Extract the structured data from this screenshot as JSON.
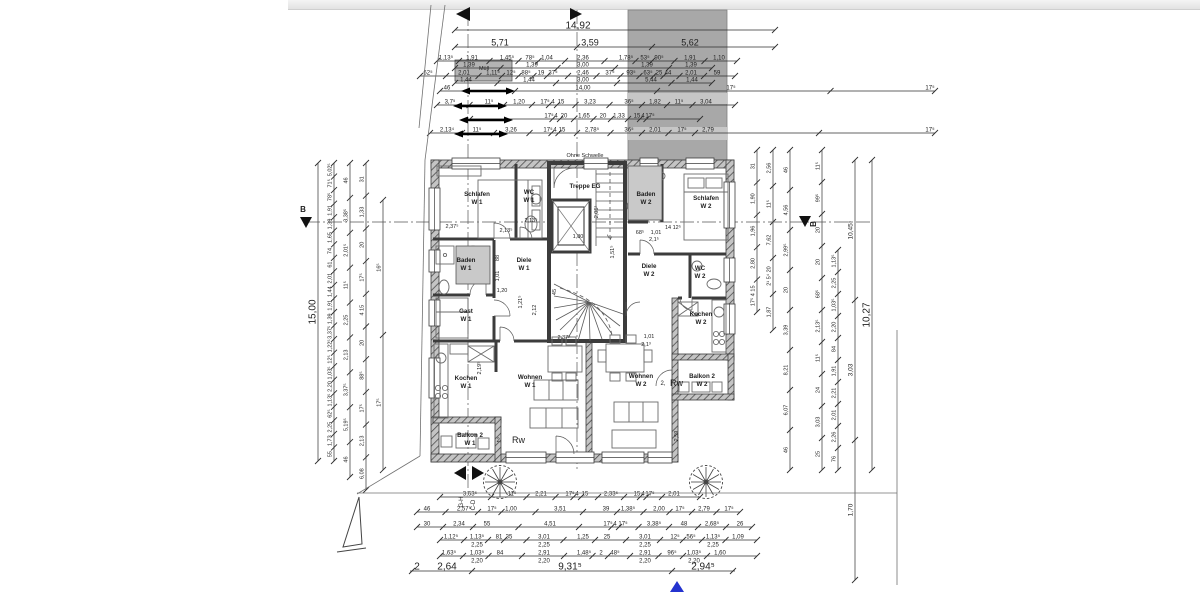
{
  "colors": {
    "blue": "#2433cf",
    "block_gray": "#a8a8a8",
    "block_band": "#c6c6c6",
    "room_gray": "#c9c9c9",
    "muell_gray": "#b3b3b3",
    "line": "#2f2f2f"
  },
  "annotations": {
    "ohne_schwelle": "Ohne Schwelle",
    "muell": "Müll",
    "rw": "Rw",
    "unit2": "2,",
    "section_b": "B",
    "gh": "G-H",
    "cd": "C-D"
  },
  "rooms": [
    {
      "lines": [
        "Schlafen",
        "W 1"
      ],
      "x": 477,
      "y": 196
    },
    {
      "lines": [
        "WC",
        "W 1"
      ],
      "x": 529,
      "y": 194
    },
    {
      "lines": [
        "Treppe EG"
      ],
      "x": 585,
      "y": 188
    },
    {
      "lines": [
        "Baden",
        "W 2"
      ],
      "x": 646,
      "y": 196,
      "rect": [
        628,
        166,
        34,
        54
      ]
    },
    {
      "lines": [
        "Schlafen",
        "W 2"
      ],
      "x": 706,
      "y": 200
    },
    {
      "lines": [
        "Baden",
        "W 1"
      ],
      "x": 466,
      "y": 262,
      "rect": [
        456,
        246,
        34,
        38
      ]
    },
    {
      "lines": [
        "Diele",
        "W 1"
      ],
      "x": 524,
      "y": 262
    },
    {
      "lines": [
        "Diele",
        "W 2"
      ],
      "x": 649,
      "y": 268
    },
    {
      "lines": [
        "WC",
        "W 2"
      ],
      "x": 700,
      "y": 270
    },
    {
      "lines": [
        "Gast",
        "W 1"
      ],
      "x": 466,
      "y": 313
    },
    {
      "lines": [
        "Kochen",
        "W 2"
      ],
      "x": 701,
      "y": 316
    },
    {
      "lines": [
        "Kochen",
        "W 1"
      ],
      "x": 466,
      "y": 380
    },
    {
      "lines": [
        "Wohnen",
        "W 1"
      ],
      "x": 530,
      "y": 379
    },
    {
      "lines": [
        "Wohnen",
        "W 2"
      ],
      "x": 641,
      "y": 378
    },
    {
      "lines": [
        "Balkon 2",
        "W 1"
      ],
      "x": 470,
      "y": 437
    },
    {
      "lines": [
        "Balkon 2",
        "W 2"
      ],
      "x": 702,
      "y": 378
    }
  ],
  "dims": {
    "top_rows": [
      {
        "y": 30,
        "x1": 455,
        "x2": 775,
        "fs": 10,
        "ticks": [
          455,
          775
        ],
        "labels": [
          {
            "t": "14,92",
            "x": 578
          }
        ]
      },
      {
        "y": 47,
        "x1": 455,
        "x2": 775,
        "fs": 9,
        "ticks": [
          455,
          577,
          652,
          775
        ],
        "labels": [
          {
            "t": "5,71",
            "x": 500
          },
          {
            "t": "3,59",
            "x": 590
          },
          {
            "t": "5,62",
            "x": 690
          }
        ]
      },
      {
        "y": 61,
        "x1": 437,
        "x2": 737,
        "labels": [
          {
            "t": "1,13⁵",
            "x": 446
          },
          {
            "t": "1,91",
            "x": 472
          },
          {
            "t": "1,45⁵",
            "x": 507
          },
          {
            "t": "78⁵",
            "x": 530
          },
          {
            "t": "1,04",
            "x": 547
          },
          {
            "t": "2,36",
            "x": 583
          },
          {
            "t": "1,78⁵",
            "x": 626
          },
          {
            "t": "53⁵",
            "x": 645
          },
          {
            "t": "90⁵",
            "x": 659
          },
          {
            "t": "1,91",
            "x": 690
          },
          {
            "t": "1,10",
            "x": 719
          }
        ]
      },
      {
        "y": 68,
        "x1": 455,
        "x2": 712,
        "labels": [
          {
            "t": "1,39",
            "x": 469
          },
          {
            "t": "1,39",
            "x": 532
          },
          {
            "t": "3,00",
            "x": 583
          },
          {
            "t": "1,39",
            "x": 647
          },
          {
            "t": "1,39",
            "x": 691
          }
        ]
      },
      {
        "y": 76,
        "x1": 420,
        "x2": 735,
        "labels": [
          {
            "t": "62⁵",
            "x": 428
          },
          {
            "t": "2,01",
            "x": 464
          },
          {
            "t": "1,11⁵",
            "x": 493
          },
          {
            "t": "12⁵",
            "x": 511
          },
          {
            "t": "88⁵",
            "x": 526
          },
          {
            "t": "19",
            "x": 541
          },
          {
            "t": "37⁵",
            "x": 553
          },
          {
            "t": "2,46",
            "x": 583
          },
          {
            "t": "37⁵",
            "x": 610
          },
          {
            "t": "93⁵",
            "x": 631
          },
          {
            "t": "63⁵",
            "x": 648
          },
          {
            "t": "25",
            "x": 659
          },
          {
            "t": "44",
            "x": 668
          },
          {
            "t": "2,01",
            "x": 691
          },
          {
            "t": "59",
            "x": 717
          }
        ]
      },
      {
        "y": 83,
        "x1": 455,
        "x2": 712,
        "labels": [
          {
            "t": "1,44",
            "x": 466
          },
          {
            "t": "1,44",
            "x": 529
          },
          {
            "t": "3,00",
            "x": 583
          },
          {
            "t": "5,44",
            "x": 651
          },
          {
            "t": "1,44",
            "x": 692
          }
        ]
      },
      {
        "y": 91,
        "x1": 440,
        "x2": 935,
        "labels": [
          {
            "t": "46",
            "x": 447
          },
          {
            "t": "14,00",
            "x": 583
          },
          {
            "t": "17⁵",
            "x": 731
          },
          {
            "t": "17⁵",
            "x": 930
          }
        ]
      },
      {
        "y": 105,
        "x1": 437,
        "x2": 735,
        "labels": [
          {
            "t": "3,7⁵",
            "x": 450
          },
          {
            "t": "11⁵",
            "x": 489
          },
          {
            "t": "1,20",
            "x": 519
          },
          {
            "t": "17⁵",
            "x": 545
          },
          {
            "t": "4",
            "x": 553
          },
          {
            "t": "15",
            "x": 561
          },
          {
            "t": "3,23",
            "x": 590
          },
          {
            "t": "36⁵",
            "x": 629
          },
          {
            "t": "1,82",
            "x": 655
          },
          {
            "t": "11⁵",
            "x": 679
          },
          {
            "t": "3,04",
            "x": 706
          }
        ]
      },
      {
        "y": 119,
        "x1": 470,
        "x2": 700,
        "labels": [
          {
            "t": "17⁵",
            "x": 549
          },
          {
            "t": "4",
            "x": 556
          },
          {
            "t": "20",
            "x": 564
          },
          {
            "t": "1,65",
            "x": 584
          },
          {
            "t": "20",
            "x": 603
          },
          {
            "t": "1,33",
            "x": 619
          },
          {
            "t": "15",
            "x": 637
          },
          {
            "t": "4",
            "x": 643
          },
          {
            "t": "17⁵",
            "x": 650
          }
        ]
      },
      {
        "y": 133,
        "x1": 430,
        "x2": 935,
        "labels": [
          {
            "t": "2,13⁴",
            "x": 447
          },
          {
            "t": "11⁵",
            "x": 477
          },
          {
            "t": "3,26",
            "x": 511
          },
          {
            "t": "17⁵",
            "x": 548
          },
          {
            "t": "4",
            "x": 555
          },
          {
            "t": "15",
            "x": 562
          },
          {
            "t": "2,78⁵",
            "x": 592
          },
          {
            "t": "36⁵",
            "x": 629
          },
          {
            "t": "2,01",
            "x": 655
          },
          {
            "t": "17⁵",
            "x": 682
          },
          {
            "t": "2,79",
            "x": 708
          },
          {
            "t": "17⁵",
            "x": 930
          }
        ]
      }
    ],
    "bottom_rows": [
      {
        "y": 497,
        "x1": 440,
        "x2": 700,
        "labels": [
          {
            "t": "3,63⁵",
            "x": 470
          },
          {
            "t": "11⁵",
            "x": 512
          },
          {
            "t": "2,21",
            "x": 541
          },
          {
            "t": "17⁵",
            "x": 570
          },
          {
            "t": "4",
            "x": 577
          },
          {
            "t": "15",
            "x": 585
          },
          {
            "t": "2,33⁵",
            "x": 611
          },
          {
            "t": "15",
            "x": 637
          },
          {
            "t": "4",
            "x": 643
          },
          {
            "t": "17⁵",
            "x": 650
          },
          {
            "t": "2,01",
            "x": 674
          }
        ]
      },
      {
        "y": 512,
        "x1": 417,
        "x2": 740,
        "labels": [
          {
            "t": "46",
            "x": 427
          },
          {
            "t": "2,57⁵",
            "x": 464
          },
          {
            "t": "17⁵",
            "x": 492
          },
          {
            "t": "1,00",
            "x": 511
          },
          {
            "t": "3,51",
            "x": 560
          },
          {
            "t": "39",
            "x": 606
          },
          {
            "t": "1,38⁵",
            "x": 628
          },
          {
            "t": "2,00",
            "x": 659
          },
          {
            "t": "17⁵",
            "x": 680
          },
          {
            "t": "2,79",
            "x": 704
          },
          {
            "t": "17⁵",
            "x": 729
          }
        ]
      },
      {
        "y": 527,
        "x1": 417,
        "x2": 752,
        "labels": [
          {
            "t": "30",
            "x": 427
          },
          {
            "t": "2,34",
            "x": 459
          },
          {
            "t": "55",
            "x": 487
          },
          {
            "t": "4,51",
            "x": 550
          },
          {
            "t": "17⁵",
            "x": 608
          },
          {
            "t": "4",
            "x": 615
          },
          {
            "t": "17⁵",
            "x": 623
          },
          {
            "t": "3,38⁵",
            "x": 654
          },
          {
            "t": "48",
            "x": 684
          },
          {
            "t": "2,68⁵",
            "x": 712
          },
          {
            "t": "26",
            "x": 740
          }
        ]
      },
      {
        "y": 540,
        "x1": 440,
        "x2": 757,
        "labels": [
          {
            "t": "1,12⁵",
            "x": 451
          },
          {
            "t": "1,13⁵",
            "x": 477
          },
          {
            "t": "81",
            "x": 499
          },
          {
            "t": "35",
            "x": 509
          },
          {
            "t": "3,01",
            "x": 544
          },
          {
            "t": "1,25",
            "x": 583
          },
          {
            "t": "25",
            "x": 607
          },
          {
            "t": "3,01",
            "x": 645
          },
          {
            "t": "12⁵",
            "x": 675
          },
          {
            "t": "56⁵",
            "x": 691
          },
          {
            "t": "1,13⁵",
            "x": 713
          },
          {
            "t": "1,09",
            "x": 738
          }
        ]
      },
      {
        "y": 548,
        "noline": true,
        "x1": 440,
        "x2": 757,
        "labels": [
          {
            "t": "2,25",
            "x": 477
          },
          {
            "t": "2,25",
            "x": 544
          },
          {
            "t": "2,25",
            "x": 645
          },
          {
            "t": "2,25",
            "x": 713
          }
        ]
      },
      {
        "y": 556,
        "x1": 440,
        "x2": 757,
        "labels": [
          {
            "t": "1,63⁵",
            "x": 449
          },
          {
            "t": "1,03⁵",
            "x": 477
          },
          {
            "t": "84",
            "x": 500
          },
          {
            "t": "2,91",
            "x": 544
          },
          {
            "t": "1,48⁵",
            "x": 584
          },
          {
            "t": "2",
            "x": 601
          },
          {
            "t": "48⁵",
            "x": 615
          },
          {
            "t": "2,91",
            "x": 645
          },
          {
            "t": "96⁵",
            "x": 672
          },
          {
            "t": "1,03⁵",
            "x": 694
          },
          {
            "t": "1,60",
            "x": 720
          }
        ]
      },
      {
        "y": 564,
        "noline": true,
        "x1": 440,
        "x2": 757,
        "labels": [
          {
            "t": "2,20",
            "x": 477
          },
          {
            "t": "2,20",
            "x": 544
          },
          {
            "t": "2,20",
            "x": 645
          },
          {
            "t": "2,20",
            "x": 694
          }
        ]
      },
      {
        "y": 571,
        "x1": 410,
        "x2": 735,
        "fs": 10,
        "ticks": [
          412,
          472,
          672,
          733
        ],
        "labels": [
          {
            "t": "2",
            "x": 417
          },
          {
            "t": "2,64",
            "x": 447
          },
          {
            "t": "9,31⁵",
            "x": 570
          },
          {
            "t": "2,94⁵",
            "x": 703
          }
        ]
      }
    ],
    "left_chains": [
      {
        "x": 318,
        "y1": 163,
        "y2": 461,
        "fs": 10,
        "labels": [
          "15,00"
        ]
      },
      {
        "x": 334,
        "y1": 163,
        "y2": 461,
        "fs": 5.5,
        "labels": [
          "5,02⁵",
          "71⁵",
          "78⁵",
          "1,91",
          "1,39",
          "1,65",
          "74",
          "61",
          "2,01",
          "1,44",
          "1,91",
          "1,39",
          "3,37⁵",
          "1,22⁵",
          "12⁵",
          "1,03⁵",
          "2,20",
          "1,13⁵",
          "62⁵",
          "2,25",
          "1,73",
          "55"
        ]
      },
      {
        "x": 350,
        "y1": 163,
        "y2": 477,
        "fs": 5.5,
        "labels": [
          "46",
          "3,38⁵",
          "2,01⁵",
          "11⁵",
          "2,25",
          "2,13",
          "3,37⁵",
          "5,19⁵",
          "46"
        ]
      },
      {
        "x": 366,
        "y1": 163,
        "y2": 490,
        "fs": 5.5,
        "labels": [
          "31",
          "1,33",
          "20",
          "17⁵",
          "4 15",
          "20",
          "88⁵",
          "17⁵",
          "2,13",
          "6,08"
        ]
      },
      {
        "x": 383,
        "y1": 200,
        "y2": 470,
        "fs": 5.5,
        "labels": [
          "16⁵",
          "17⁵"
        ]
      }
    ],
    "right_chains": [
      {
        "x": 757,
        "y1": 150,
        "y2": 312,
        "fs": 5.5,
        "labels": [
          "31",
          "1,90",
          "1,96",
          "2,80",
          "17⁵ 4 15"
        ]
      },
      {
        "x": 773,
        "y1": 150,
        "y2": 330,
        "fs": 5.5,
        "labels": [
          "2,56",
          "11⁵",
          "7,62",
          "2¹ 5⁴ 20",
          "1,87"
        ]
      },
      {
        "x": 790,
        "y1": 150,
        "y2": 470,
        "fs": 5.5,
        "labels": [
          "46",
          "4,56",
          "2,99⁵",
          "20",
          "3,39",
          "8,21",
          "6,07",
          "46"
        ]
      },
      {
        "x": 822,
        "y1": 150,
        "y2": 470,
        "fs": 5.5,
        "labels": [
          "11⁵",
          "99⁵",
          "20",
          "20",
          "68⁵",
          "2,13⁵",
          "11⁵",
          "24",
          "3,03",
          "25"
        ]
      },
      {
        "x": 838,
        "y1": 250,
        "y2": 470,
        "fs": 5.5,
        "labels": [
          "1,13⁵",
          "2,25",
          "1,03⁵",
          "2,20",
          "84",
          "1,91",
          "2,21",
          "2,01",
          "2,26",
          "76"
        ]
      },
      {
        "x": 855,
        "y1": 160,
        "y2": 580,
        "fs": 6.5,
        "labels": [
          "10,45⁵",
          "3,03",
          "1,70"
        ]
      },
      {
        "x": 872,
        "y1": 160,
        "y2": 470,
        "fs": 10,
        "labels": [
          "10,27"
        ]
      }
    ]
  },
  "inner_dims": [
    {
      "t": "2,37⁵",
      "x": 452,
      "y": 228
    },
    {
      "t": "2,13⁵",
      "x": 506,
      "y": 232
    },
    {
      "t": "2,13⁵",
      "x": 531,
      "y": 222
    },
    {
      "t": "68⁵",
      "x": 640,
      "y": 234
    },
    {
      "t": "1,01",
      "x": 656,
      "y": 234
    },
    {
      "t": "14 12⁵",
      "x": 673,
      "y": 229
    },
    {
      "t": "2,1⁵",
      "x": 654,
      "y": 241
    },
    {
      "t": "1,80",
      "x": 578,
      "y": 238
    },
    {
      "t": "2,05¹",
      "x": 598,
      "y": 212,
      "rot": 1
    },
    {
      "t": "88",
      "x": 499,
      "y": 258,
      "rot": 1
    },
    {
      "t": "1,01",
      "x": 499,
      "y": 276,
      "rot": 1
    },
    {
      "t": "1,20",
      "x": 502,
      "y": 292
    },
    {
      "t": "2,12",
      "x": 536,
      "y": 310,
      "rot": 1
    },
    {
      "t": "1,21⁵",
      "x": 522,
      "y": 302,
      "rot": 1
    },
    {
      "t": "2,37⁵",
      "x": 564,
      "y": 339
    },
    {
      "t": "1,01",
      "x": 649,
      "y": 338
    },
    {
      "t": "2,1³",
      "x": 646,
      "y": 346
    },
    {
      "t": "2,19⁵",
      "x": 481,
      "y": 368,
      "rot": 1
    },
    {
      "t": "2,59",
      "x": 678,
      "y": 436,
      "rot": 1
    },
    {
      "t": "1,51⁵",
      "x": 614,
      "y": 252,
      "rot": 1
    },
    {
      "t": "45",
      "x": 556,
      "y": 292,
      "rot": 1
    }
  ]
}
